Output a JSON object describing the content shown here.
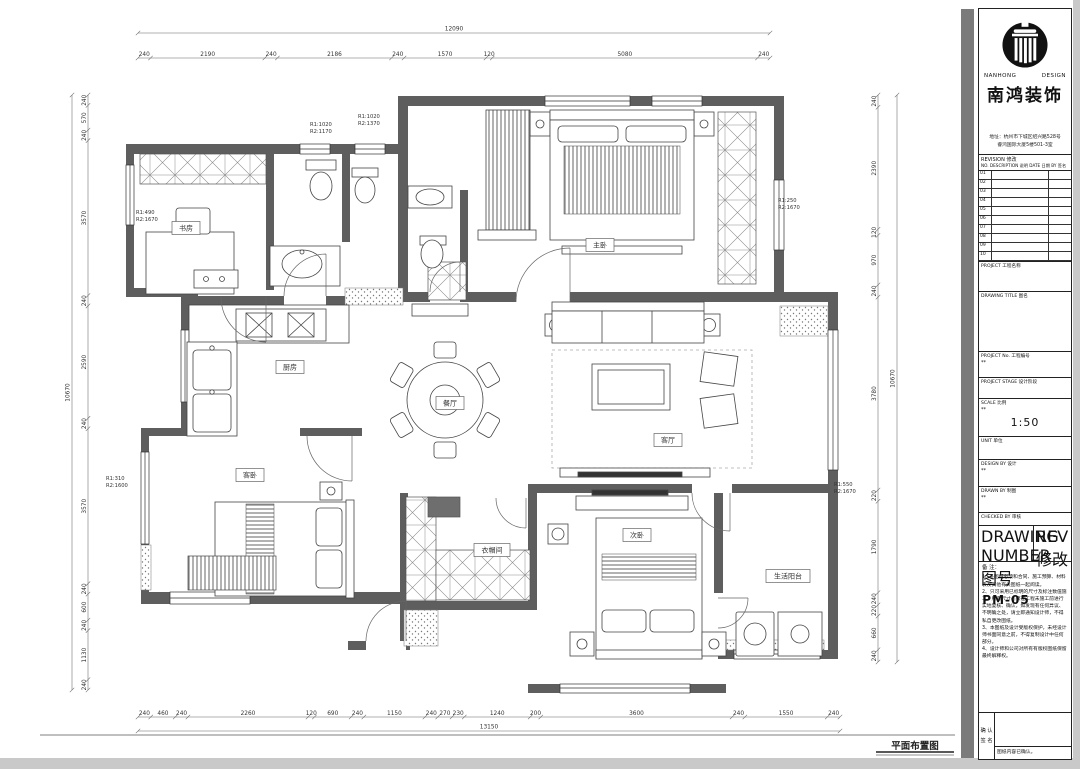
{
  "plan": {
    "drawing_label": "平面布置图",
    "rooms": [
      {
        "id": "study",
        "label": "书房"
      },
      {
        "id": "master",
        "label": "主卧"
      },
      {
        "id": "kitchen",
        "label": "厨房"
      },
      {
        "id": "dining",
        "label": "餐厅"
      },
      {
        "id": "living",
        "label": "客厅"
      },
      {
        "id": "guest",
        "label": "客卧"
      },
      {
        "id": "closet",
        "label": "衣帽间"
      },
      {
        "id": "bed2",
        "label": "次卧"
      },
      {
        "id": "balcony",
        "label": "生活阳台"
      }
    ],
    "window_notes": [
      {
        "id": "w1",
        "lines": [
          "R1:1020",
          "R2:1170"
        ]
      },
      {
        "id": "w2",
        "lines": [
          "R1:1020",
          "R2:1370"
        ]
      },
      {
        "id": "w3",
        "lines": [
          "R1:490",
          "R2:1670"
        ]
      },
      {
        "id": "w4",
        "lines": [
          "R1:250",
          "R2:1670"
        ]
      },
      {
        "id": "w5",
        "lines": [
          "R1:310",
          "R2:1600"
        ]
      },
      {
        "id": "w6",
        "lines": [
          "R1:550",
          "R2:1670"
        ]
      }
    ],
    "dimensions": {
      "top": {
        "total": "12090",
        "segments": [
          240,
          2190,
          240,
          2186,
          240,
          1570,
          120,
          5080,
          240
        ]
      },
      "bottom": {
        "total": "13150",
        "segments": [
          240,
          460,
          240,
          2260,
          120,
          690,
          240,
          1150,
          240,
          270,
          230,
          1240,
          200,
          3600,
          240,
          1550,
          240
        ]
      },
      "left": {
        "total": "10670",
        "segments": [
          240,
          570,
          240,
          3570,
          240,
          2590,
          240,
          3570,
          240,
          600,
          240,
          1130,
          240
        ]
      },
      "right": {
        "total": "10670",
        "segments": [
          240,
          2390,
          120,
          970,
          240,
          3780,
          220,
          1790,
          240,
          220,
          660,
          240
        ]
      }
    }
  },
  "title_block": {
    "brand_en_left": "NANHONG",
    "brand_en_right": "DESIGN",
    "company": "南鸿装饰",
    "address_line1": "地址：杭州市下城区绍兴路528号",
    "address_line2": "睿鸿国际大厦5楼501-3室",
    "revision": {
      "title": "REVISION 修改",
      "columns": "NO.  DESCRIPTION 说明  DATE 日期  BY 签名",
      "rows": [
        "01",
        "02",
        "03",
        "04",
        "05",
        "06",
        "07",
        "08",
        "09",
        "10"
      ]
    },
    "fields": [
      {
        "id": "project",
        "label": "PROJECT  工程名称",
        "value": ""
      },
      {
        "id": "dtitle",
        "label": "DRAWING TITLE  图名",
        "value": ""
      },
      {
        "id": "pno",
        "label": "PROJECT No.  工程编号",
        "value": "**"
      },
      {
        "id": "pstage",
        "label": "PROJECT STAGE  设计阶段",
        "value": ""
      },
      {
        "id": "scale",
        "label": "SCALE  比例",
        "value": "1:50",
        "value2": "**"
      },
      {
        "id": "unit",
        "label": "UNIT  单位",
        "value": ""
      },
      {
        "id": "design",
        "label": "DESIGN BY  设计",
        "value": "**"
      },
      {
        "id": "drawn",
        "label": "DRAWN BY  制图",
        "value": "**"
      },
      {
        "id": "checked",
        "label": "CHECKED BY  审核",
        "value": ""
      }
    ],
    "drawing_number": {
      "label": "DRAWING NUMBER 图号",
      "value": "PM-05"
    },
    "rev_box": {
      "label": "REV 修改",
      "value": ""
    },
    "notes": {
      "title": "备 注：",
      "items": [
        "1、※图纸必须和合同、施工预算、材料表及其他有关图纸一起阅读。",
        "2、只可采用已标明的尺寸及标注数值施工，所有尺寸必须在工程未施工前进行实地复核、确认，如发现有任何异议、不明确之处，请立即通知设计师，不得私自更改图纸。",
        "3、本图纸及设计受版权保护，未经设计师书面同意之前，不得复制设计中任何部分。",
        "4、设计师和公司对所有有版权图纸保留最终解释权。"
      ]
    },
    "confirm": {
      "label1": "确 认",
      "label2": "签 名",
      "note": "图纸内容已确认。"
    }
  }
}
